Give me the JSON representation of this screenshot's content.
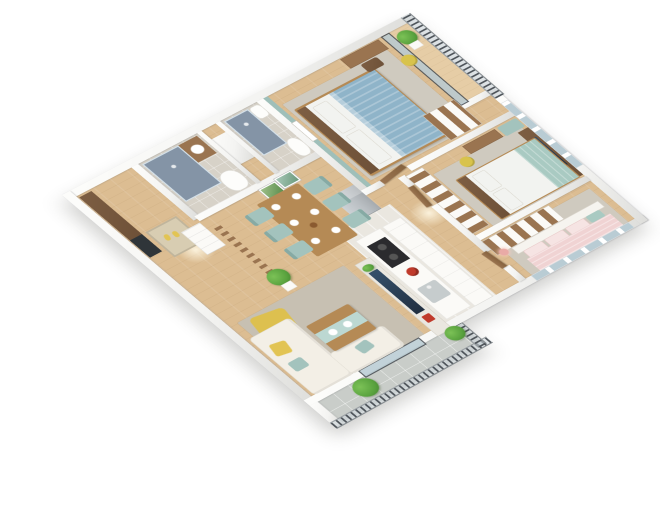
{
  "scene": {
    "type": "isometric-3d-apartment-floorplan-render",
    "background": "#ffffff"
  },
  "colors": {
    "background": "#ffffff",
    "wall": "#f4f4f2",
    "wall-edge": "#dededb",
    "floor-wood": "#dcbd92",
    "floor-wood-light": "#e6cda6",
    "floor-marble": "#eae7e0",
    "floor-tile-bath": "#d7d2c8",
    "floor-tile-balcony": "#c9cdc9",
    "rug-living": "#c7c0b2",
    "rug-bedroom": "#cfcabf",
    "accent-teal": "#9fbfb9",
    "bed-blue": "#8fb4c9",
    "bed-teal": "#a9cac2",
    "bed-pink": "#f0d3d3",
    "pillow-white": "#f2f3f0",
    "sofa-white": "#f3efe6",
    "pillow-yellow": "#e2c453",
    "chair-teal": "#a3c3bd",
    "armchair-yellow": "#ddc04f",
    "stool-yellow": "#d8c34c",
    "wood-dark": "#6e5138",
    "wood-mid": "#9a7450",
    "wood-light": "#b58a55",
    "cabinet-white": "#fbfaf7",
    "fridge-silver": "#b9bec2",
    "cooktop-black": "#2b2b2e",
    "kettle-red": "#c03a2b",
    "tv-screen": "#223041",
    "shower-tile": "#8494a6",
    "glass": "#b9ccd4",
    "railing-dark": "#4e545a",
    "plant-green": "#5aa33f",
    "doormat": "#d8cdb2"
  },
  "rooms": [
    {
      "id": "entrance-hall",
      "furniture": [
        "entry-wardrobe",
        "dark-cabinet",
        "doormat",
        "yellow-slippers",
        "drawer-dresser"
      ]
    },
    {
      "id": "bathroom-1",
      "furniture": [
        "shower",
        "vanity-sink",
        "toilet"
      ]
    },
    {
      "id": "bathroom-2",
      "furniture": [
        "shower",
        "sink",
        "toilet"
      ]
    },
    {
      "id": "master-bedroom",
      "furniture": [
        "double-bed-blue",
        "teal-accent-wall",
        "wall-art",
        "desk",
        "chair",
        "yellow-stool",
        "wardrobe",
        "gray-rug"
      ]
    },
    {
      "id": "master-balcony",
      "furniture": [
        "potted-plant",
        "railing",
        "sliding-glass-door"
      ]
    },
    {
      "id": "bedroom-2",
      "furniture": [
        "double-bed-teal-white",
        "tv-wood-panel",
        "tv",
        "desk",
        "window-seat",
        "yellow-stool",
        "wardrobe",
        "gray-rug"
      ]
    },
    {
      "id": "bedroom-3",
      "furniture": [
        "double-bed-pink",
        "wardrobe",
        "nightstand",
        "pink-table-lamp",
        "gray-rug",
        "windows"
      ]
    },
    {
      "id": "kitchen",
      "furniture": [
        "island-counter",
        "cooktop",
        "red-kettle",
        "sink",
        "tall-cabinets",
        "refrigerator"
      ]
    },
    {
      "id": "dining-area",
      "furniture": [
        "wood-dining-table",
        "six-teal-chairs",
        "white-plates",
        "two-wall-art-frames",
        "wood-slat-partition",
        "potted-plant"
      ]
    },
    {
      "id": "living-room",
      "furniture": [
        "white-corner-sofa",
        "yellow-armchair",
        "yellow-pillow",
        "teal-pillows",
        "coffee-table-teal-runner",
        "marble-tv-wall",
        "tv",
        "red-decor"
      ]
    },
    {
      "id": "living-balcony",
      "furniture": [
        "shrub-large",
        "shrub-small",
        "railing",
        "sliding-glass-door",
        "gray-tile-floor"
      ]
    },
    {
      "id": "corridor",
      "furniture": [
        "wood-doors"
      ]
    }
  ]
}
